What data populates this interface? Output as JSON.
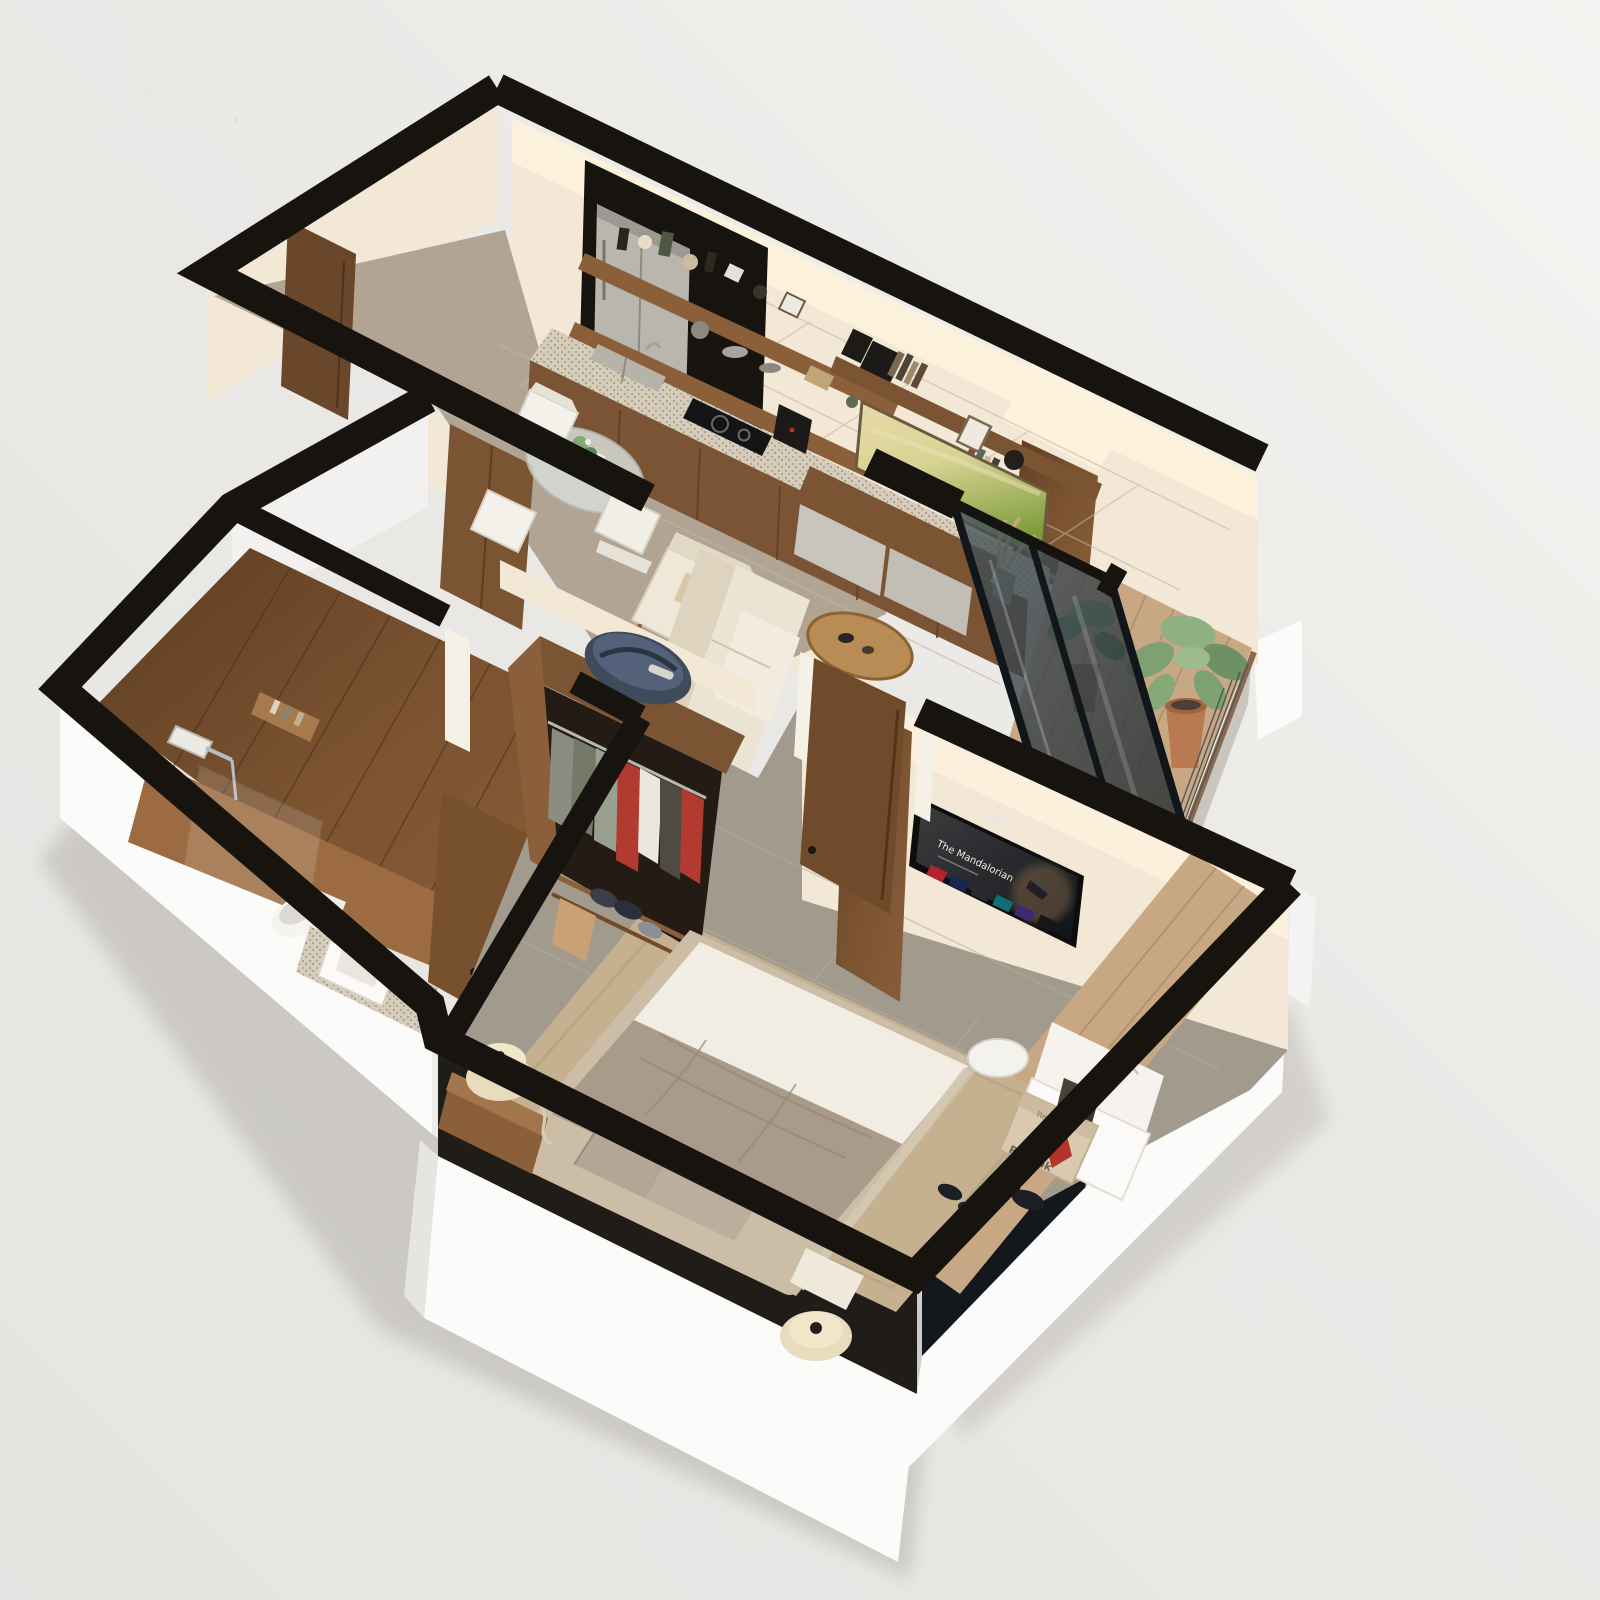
{
  "meta": {
    "scene": "isometric-3d-floor-plan-cutaway-render",
    "unit": "one-bedroom-apartment"
  },
  "palette": {
    "background": "#e9e8e5",
    "background_bright": "#f5f5f3",
    "wall_top": "#17130e",
    "wall_face": "#f3e8d5",
    "wall_face_lit": "#fdf3dd",
    "exterior_white": "#fbfbfa",
    "exterior_gray": "#e2e1de",
    "floor_tile": "#b2a492",
    "bedroom_tile": "#a29a8d",
    "grout": "#c6bbaa",
    "wood_walnut": "#6f4a2b",
    "wood_walnut_light": "#8a5f3a",
    "wood_oak": "#c8a884",
    "granite": "#d2c7b4",
    "rug": "#c5b190",
    "bed_white": "#f2ede2",
    "bed_taupe": "#a99b8a",
    "bed_frame": "#cbbda6",
    "sofa_cream": "#ece4d3",
    "plant_green": "#7da173",
    "terracotta": "#b97a52",
    "glass_dark": "#2c3a42",
    "stainless": "#b9b6ad",
    "shadow": "#9a948c"
  },
  "rooms": {
    "kitchen_living": {
      "id": "kitchen-living-room",
      "furniture": [
        "fridge",
        "floating-shelves",
        "kitchen-counter",
        "sink",
        "cooktop",
        "coffee-maker",
        "dining-table",
        "dining-chairs",
        "landscape-painting",
        "wall-shelf",
        "tv-bench",
        "armchair",
        "sofa",
        "coffee-table",
        "pampas-vase"
      ]
    },
    "entry_hall": {
      "id": "entry-hall",
      "furniture": [
        "entry-door",
        "wardrobe"
      ]
    },
    "bathroom": {
      "id": "bathroom",
      "furniture": [
        "walk-in-shower",
        "shower-niche",
        "glass-partition",
        "toilet",
        "vanity-sink",
        "bathroom-door"
      ]
    },
    "bedroom": {
      "id": "bedroom",
      "furniture": [
        "double-bed",
        "pillows",
        "nightstand",
        "rattan-lamps",
        "jute-rug",
        "wall-tv",
        "open-closet",
        "duffel-bag",
        "clothes-rail",
        "shoe-shelf",
        "desk-nook",
        "desk-chair",
        "shoe-box",
        "sneakers",
        "slippers",
        "bedroom-door"
      ]
    },
    "balcony": {
      "id": "balcony",
      "furniture": [
        "potted-plants",
        "wire-railing",
        "sliding-glass-door",
        "wood-deck"
      ]
    }
  },
  "tv": {
    "title": "The Mandalorian"
  },
  "shoe_box": {
    "brand": "Reebok"
  }
}
